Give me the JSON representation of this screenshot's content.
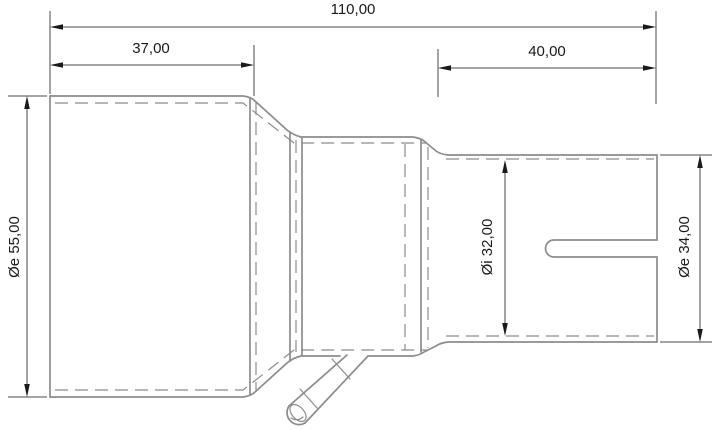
{
  "drawing": {
    "dimensions": {
      "total_length": "110,00",
      "left_section_length": "37,00",
      "right_section_length": "40,00",
      "left_outer_diameter": "Øe 55,00",
      "inner_diameter": "Øi 32,00",
      "right_outer_diameter": "Øe 34,00"
    },
    "colors": {
      "background": "#ffffff",
      "object_line": "#8c8c8c",
      "dimension_line": "#4a4a4a",
      "text": "#1a1a1a"
    }
  }
}
